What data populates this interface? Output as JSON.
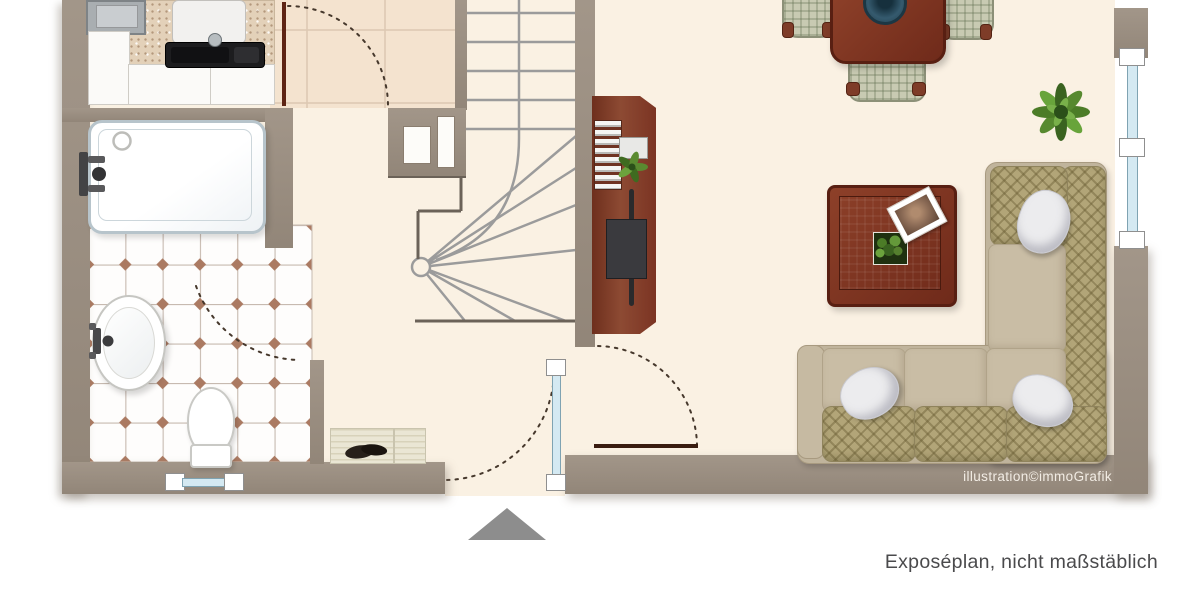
{
  "captions": {
    "credit": "illustration©immoGrafik",
    "disclaimer": "Exposéplan, nicht maßstäblich"
  },
  "palette": {
    "wall": "#9b8e80",
    "floor": "#faf1e3",
    "kitchen_floor": "#f4e3cf",
    "tile_line": "#c7bab0",
    "tile_accent": "#ab7a62",
    "wood": "#7c3120",
    "wood_dark": "#5e2414",
    "stair_line": "#9b9b9b",
    "glass": "#d4e9f2",
    "sofa_seat": "#c9bda5",
    "sofa_cushion": "#b2a578",
    "plant": "#4c7c27",
    "arrow": "#8d8d8d",
    "caption_text": "#4a4a4c",
    "credit_text": "#f2ece4"
  },
  "plan": {
    "rooms": [
      {
        "name": "kitchen",
        "items": [
          "stove",
          "countertop",
          "kitchen-sink",
          "cabinets",
          "door-with-swing"
        ]
      },
      {
        "name": "bathroom",
        "items": [
          "bathtub",
          "washbasin",
          "toilet",
          "tiled-floor",
          "window",
          "door-swing"
        ]
      },
      {
        "name": "hallway",
        "items": [
          "winding-staircase",
          "shoe-bench",
          "glazed-entrance-door",
          "entrance-arrow"
        ]
      },
      {
        "name": "living-room",
        "items": [
          "dining-table",
          "dining-chairs",
          "sideboard",
          "tv",
          "coffee-table",
          "corner-sofa",
          "potted-plant",
          "window",
          "door-with-swing"
        ]
      }
    ]
  }
}
